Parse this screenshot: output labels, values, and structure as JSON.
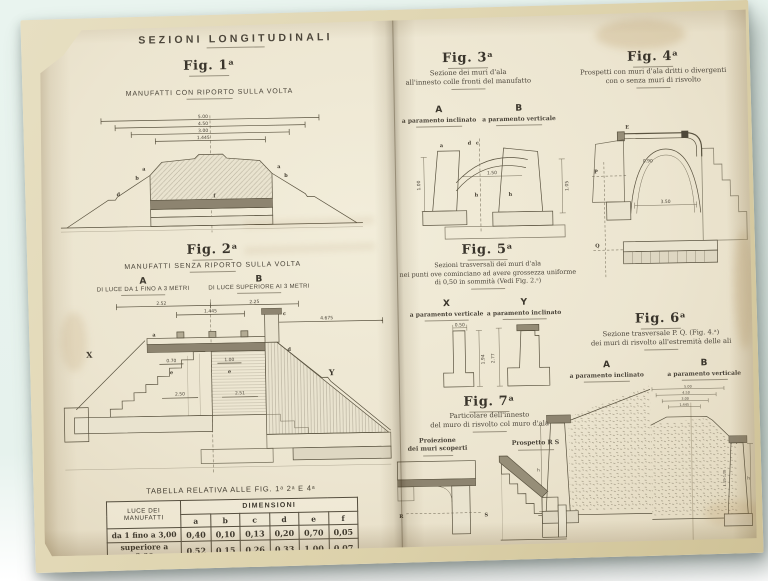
{
  "left_page": {
    "section_title": "SEZIONI LONGITUDINALI",
    "fig1": {
      "label": "Fig. 1ᵃ",
      "caption": "MANUFATTI CON RIPORTO SULLA VOLTA",
      "dims": [
        "5.00",
        "4.50",
        "3.00",
        "1.445"
      ],
      "marks": {
        "a_left": "a",
        "b_left": "b",
        "a_right": "a",
        "b_right": "b",
        "d": "d",
        "f": "f"
      }
    },
    "fig2": {
      "label": "Fig. 2ᵃ",
      "caption": "MANUFATTI SENZA RIPORTO SULLA VOLTA",
      "col_a": {
        "letter": "A",
        "caption": "DI LUCE DA 1 FINO A 3 METRI"
      },
      "col_b": {
        "letter": "B",
        "caption": "DI LUCE SUPERIORE AI 3 METRI"
      },
      "marks": {
        "x": "X",
        "y": "Y",
        "a": "a",
        "c": "c",
        "d": "d",
        "e_left": "e",
        "e_right": "e"
      },
      "dims": {
        "top_left": "2.52",
        "top_right": "2.25",
        "inner": "1.445",
        "right": "4.675",
        "h_left": "0.70",
        "h_right": "1.00",
        "v_left": "2.50",
        "v_right": "2.51"
      }
    },
    "table": {
      "title": "TABELLA RELATIVA ALLE FIG. 1ᵃ 2ᵃ E 4ᵃ",
      "row_header": "LUCE DEI MANUFATTI",
      "group_header": "DIMENSIONI",
      "columns": [
        "a",
        "b",
        "c",
        "d",
        "e",
        "f"
      ],
      "rows": [
        {
          "label": "da 1 fino a 3,00",
          "values": [
            "0,40",
            "0,10",
            "0,13",
            "0,20",
            "0,70",
            "0,05"
          ]
        },
        {
          "label": "superiore a 3,00",
          "values": [
            "0,52",
            "0,15",
            "0,26",
            "0,33",
            "1,00",
            "0,07"
          ]
        }
      ]
    }
  },
  "right_page": {
    "fig3": {
      "label": "Fig. 3ᵃ",
      "caption_line1": "Sezione dei muri d'ala",
      "caption_line2": "all'innesto colle fronti del manufatto",
      "col_a": {
        "letter": "A",
        "caption": "a paramento inclinato"
      },
      "col_b": {
        "letter": "B",
        "caption": "a paramento verticale"
      },
      "dims": {
        "left": "1.00",
        "right": "1.05",
        "mid": "1.50"
      },
      "marks": {
        "a": "a",
        "d": "d",
        "c": "c",
        "h1": "h",
        "h2": "h"
      }
    },
    "fig4": {
      "label": "Fig. 4ᵃ",
      "caption_line1": "Prospetti con muri d'ala dritti o divergenti",
      "caption_line2": "con o senza muri di risvolto",
      "dims": {
        "span": "3.50",
        "rise": "0.90"
      },
      "marks": {
        "p": "P",
        "q": "Q",
        "e": "E"
      }
    },
    "fig5": {
      "label": "Fig. 5ᵃ",
      "caption_line1": "Sezioni trasversali dei muri d'ala",
      "caption_line2": "nei punti ove cominciano ad avere grossezza uniforme",
      "caption_line3": "di 0,50 in sommità (Vedi Fig. 2.ᵃ)",
      "col_x": {
        "letter": "X",
        "caption": "a paramento verticale"
      },
      "col_y": {
        "letter": "Y",
        "caption": "a paramento inclinato"
      },
      "dims": {
        "top": "0.50",
        "x_height": "1.94",
        "y_height": "2.77"
      }
    },
    "fig6": {
      "label": "Fig. 6ᵃ",
      "caption_line1": "Sezione trasversale P. Q. (Fig. 4.ᵃ)",
      "caption_line2": "dei muri di risvolto all'estremità delle ali",
      "col_a": {
        "letter": "A",
        "caption": "a paramento inclinato"
      },
      "col_b": {
        "letter": "B",
        "caption": "a paramento verticale"
      },
      "dims": {
        "d1": "5.00",
        "d2": "4.50",
        "d3": "3.00",
        "d4": "1.445",
        "wall": "1.00–1.05",
        "h_a": "h",
        "h_b": "h"
      }
    },
    "fig7": {
      "label": "Fig. 7ᵃ",
      "caption_line1": "Particolare dell'innesto",
      "caption_line2": "del muro di risvolto col muro d'ala",
      "sub1_line1": "Proiezione",
      "sub1_line2": "dei muri scoperti",
      "sub2": "Prospetto R S",
      "marks": {
        "r": "R",
        "s": "S"
      }
    }
  }
}
